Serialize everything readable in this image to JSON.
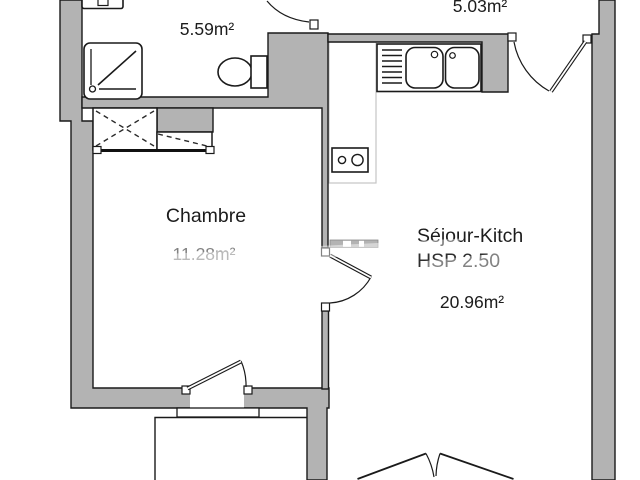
{
  "title": "apartment floor plan",
  "labels": {
    "bathroom_area": "5.59m²",
    "entry_area": "5.03m²",
    "bedroom_name": "Chambre",
    "bedroom_area": "11.28m²",
    "living_name": "Séjour-Kitch",
    "living_ceiling_height": "HSP 2.50",
    "living_area": "20.96m²"
  },
  "colors": {
    "wall_fill": "#b3b3b3",
    "line": "#1a1a1a",
    "floor": "#ffffff",
    "muted_text": "#818181",
    "counter_outline": "#c4c4c4"
  },
  "icons": {
    "fixtures": [
      "washbasin-icon",
      "shower-icon",
      "toilet-icon",
      "double-sink-icon",
      "cooktop-icon",
      "wardrobe-dashed-cross-icon"
    ],
    "doors": [
      "bathroom-door",
      "entry-door",
      "living-room-door",
      "bedroom-door",
      "balcony-double-door"
    ]
  }
}
